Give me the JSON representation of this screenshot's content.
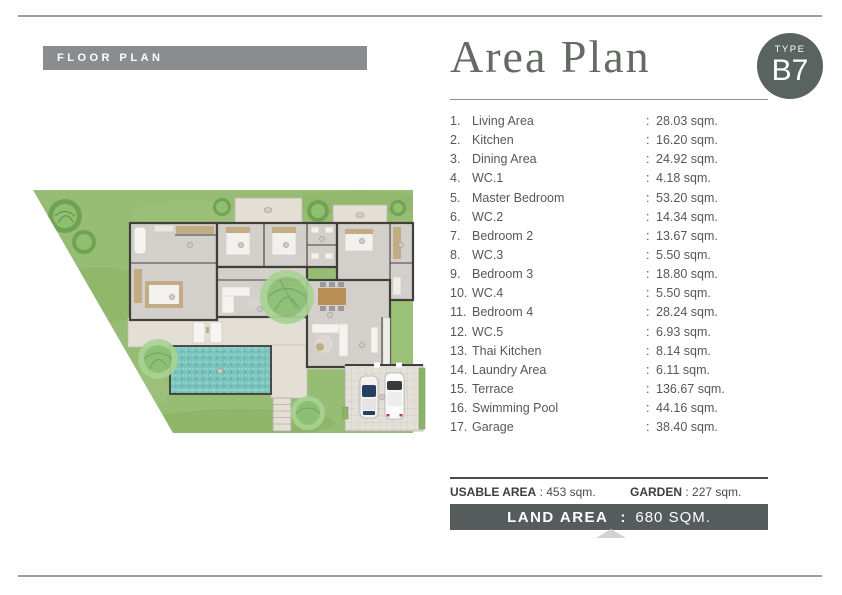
{
  "header": {
    "floorplan_banner": "FLOOR PLAN",
    "title": "Area Plan",
    "type_badge": {
      "label": "TYPE",
      "code": "B7"
    }
  },
  "area_list": {
    "separator": ":",
    "items": [
      {
        "num": "1.",
        "label": "Living Area",
        "area": "28.03 sqm."
      },
      {
        "num": "2.",
        "label": "Kitchen",
        "area": "16.20 sqm."
      },
      {
        "num": "3.",
        "label": "Dining Area",
        "area": "24.92 sqm."
      },
      {
        "num": "4.",
        "label": "WC.1",
        "area": "4.18 sqm."
      },
      {
        "num": "5.",
        "label": "Master Bedroom",
        "area": "53.20 sqm."
      },
      {
        "num": "6.",
        "label": "WC.2",
        "area": "14.34 sqm."
      },
      {
        "num": "7.",
        "label": "Bedroom 2",
        "area": "13.67 sqm."
      },
      {
        "num": "8.",
        "label": "WC.3",
        "area": "5.50 sqm."
      },
      {
        "num": "9.",
        "label": "Bedroom 3",
        "area": "18.80 sqm."
      },
      {
        "num": "10.",
        "label": "WC.4",
        "area": "5.50 sqm."
      },
      {
        "num": "11.",
        "label": "Bedroom 4",
        "area": "28.24 sqm."
      },
      {
        "num": "12.",
        "label": "WC.5",
        "area": "6.93 sqm."
      },
      {
        "num": "13.",
        "label": "Thai Kitchen",
        "area": "8.14 sqm."
      },
      {
        "num": "14.",
        "label": "Laundry Area",
        "area": "6.11 sqm."
      },
      {
        "num": "15.",
        "label": "Terrace",
        "area": "136.67 sqm."
      },
      {
        "num": "16.",
        "label": "Swimming Pool",
        "area": "44.16 sqm."
      },
      {
        "num": "17.",
        "label": "Garage",
        "area": "38.40 sqm."
      }
    ]
  },
  "summary": {
    "usable_label": "USABLE AREA",
    "usable_value": ": 453 sqm.",
    "garden_label": "GARDEN",
    "garden_value": ": 227 sqm.",
    "land_label": "LAND AREA",
    "land_separator": ":",
    "land_value": "680  SQM."
  },
  "palette": {
    "banner_gray": "#8a8d8e",
    "badge_green_gray": "#59635f",
    "land_banner": "#565c5c",
    "lawn_green": "#97bc73",
    "pool_teal": "#7ac2bc",
    "terrace_beige": "#e4dfd4",
    "wall_dark": "#413f3c",
    "room_floor": "#d3d0cb",
    "wood_tan": "#c2ac84"
  }
}
